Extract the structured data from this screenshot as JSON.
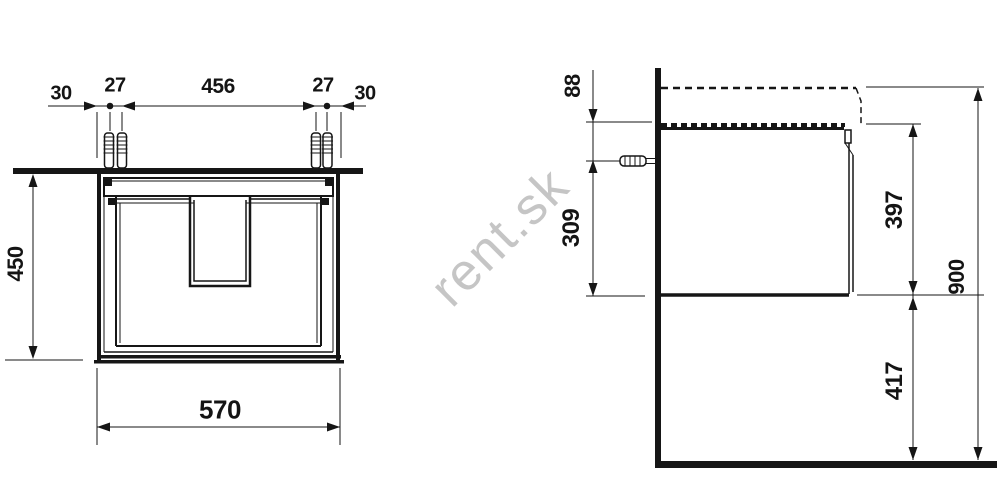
{
  "watermark": {
    "text": "rent.sk",
    "color": "#c5c5c5"
  },
  "colors": {
    "line": "#161616",
    "background": "#ffffff"
  },
  "front_view": {
    "title": "vanity-unit-front-view",
    "dims": {
      "left_edge_to_screw": "30",
      "left_screw_pair_gap": "27",
      "screw_span": "456",
      "right_screw_pair_gap": "27",
      "screw_to_right_edge": "30",
      "cabinet_height": "450",
      "cabinet_width": "570"
    }
  },
  "side_view": {
    "title": "vanity-unit-side-view",
    "dims": {
      "cabinet_top_to_screw": "88",
      "screw_to_cabinet_bottom": "309",
      "cabinet_height": "397",
      "floor_to_cabinet_bottom": "417",
      "floor_to_basin_top": "900"
    }
  }
}
